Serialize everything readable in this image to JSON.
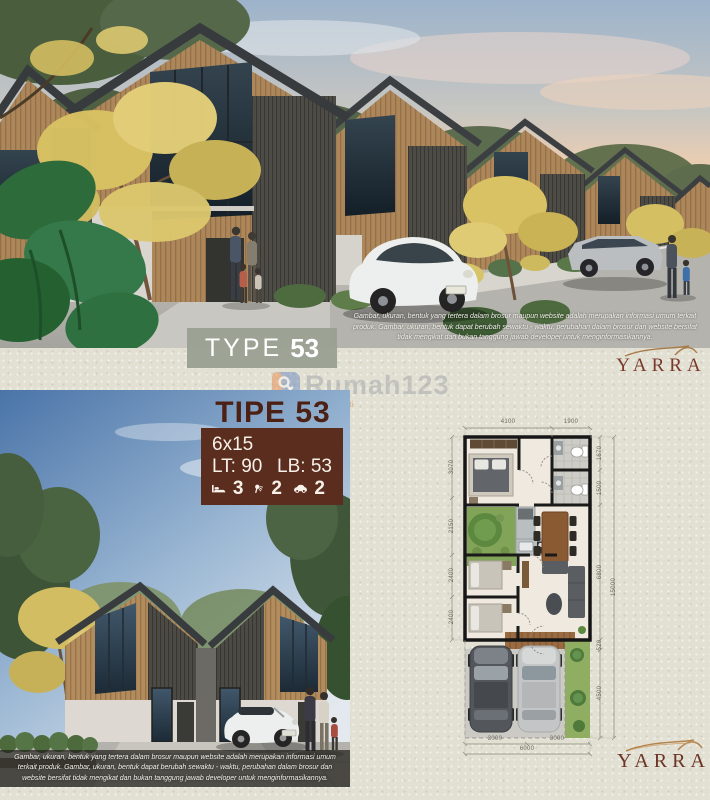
{
  "brand": {
    "name": "YARRA"
  },
  "top_panel": {
    "type_badge": {
      "prefix": "TYPE",
      "number": "53"
    },
    "disclaimer": "Gambar, ukuran, bentuk yang tertera dalam brosur maupun website adalah merupakan informasi umum terkait produk. Gambar, ukuran, bentuk dapat berubah sewaktu - waktu, perubahan dalam brosur dan website bersifat tidak mengikat dan bukan tanggung jawab developer untuk menginformasikannya."
  },
  "bottom_panel": {
    "title": {
      "prefix": "TIPE",
      "number": "53"
    },
    "spec_box": {
      "size": "6x15",
      "lt_label": "LT:",
      "lt_value": "90",
      "lb_label": "LB:",
      "lb_value": "53",
      "bedrooms": "3",
      "bathrooms": "2",
      "carports": "2"
    },
    "disclaimer": "Gambar, ukuran, bentuk yang tertera dalam brosur maupun website adalah merupakan informasi umum terkait produk. Gambar, ukuran, bentuk dapat berubah sewaktu - waktu, perubahan dalam brosur dan website bersifat tidak mengikat dan bukan tanggung jawab developer untuk menginformasikannya."
  },
  "floor_plan": {
    "dims_top": [
      "4100",
      "1900"
    ],
    "dims_left": [
      "3070",
      "2150",
      "2400",
      "2400"
    ],
    "dims_right": [
      "1670",
      "1500",
      "6800",
      "520",
      "4500"
    ],
    "dims_right_total": "15000",
    "dims_bottom": [
      "3000",
      "3000"
    ],
    "dims_bottom_total": "6000"
  },
  "watermark": {
    "text": "Rumah123",
    "tagline": "Jual Properti"
  },
  "colors": {
    "badge_sage": "#9aa192",
    "spec_brown": "#5b2d1f",
    "title_brown": "#4c2114",
    "brand_maroon": "#7a392a",
    "background_beige": "#e2dfd3"
  }
}
